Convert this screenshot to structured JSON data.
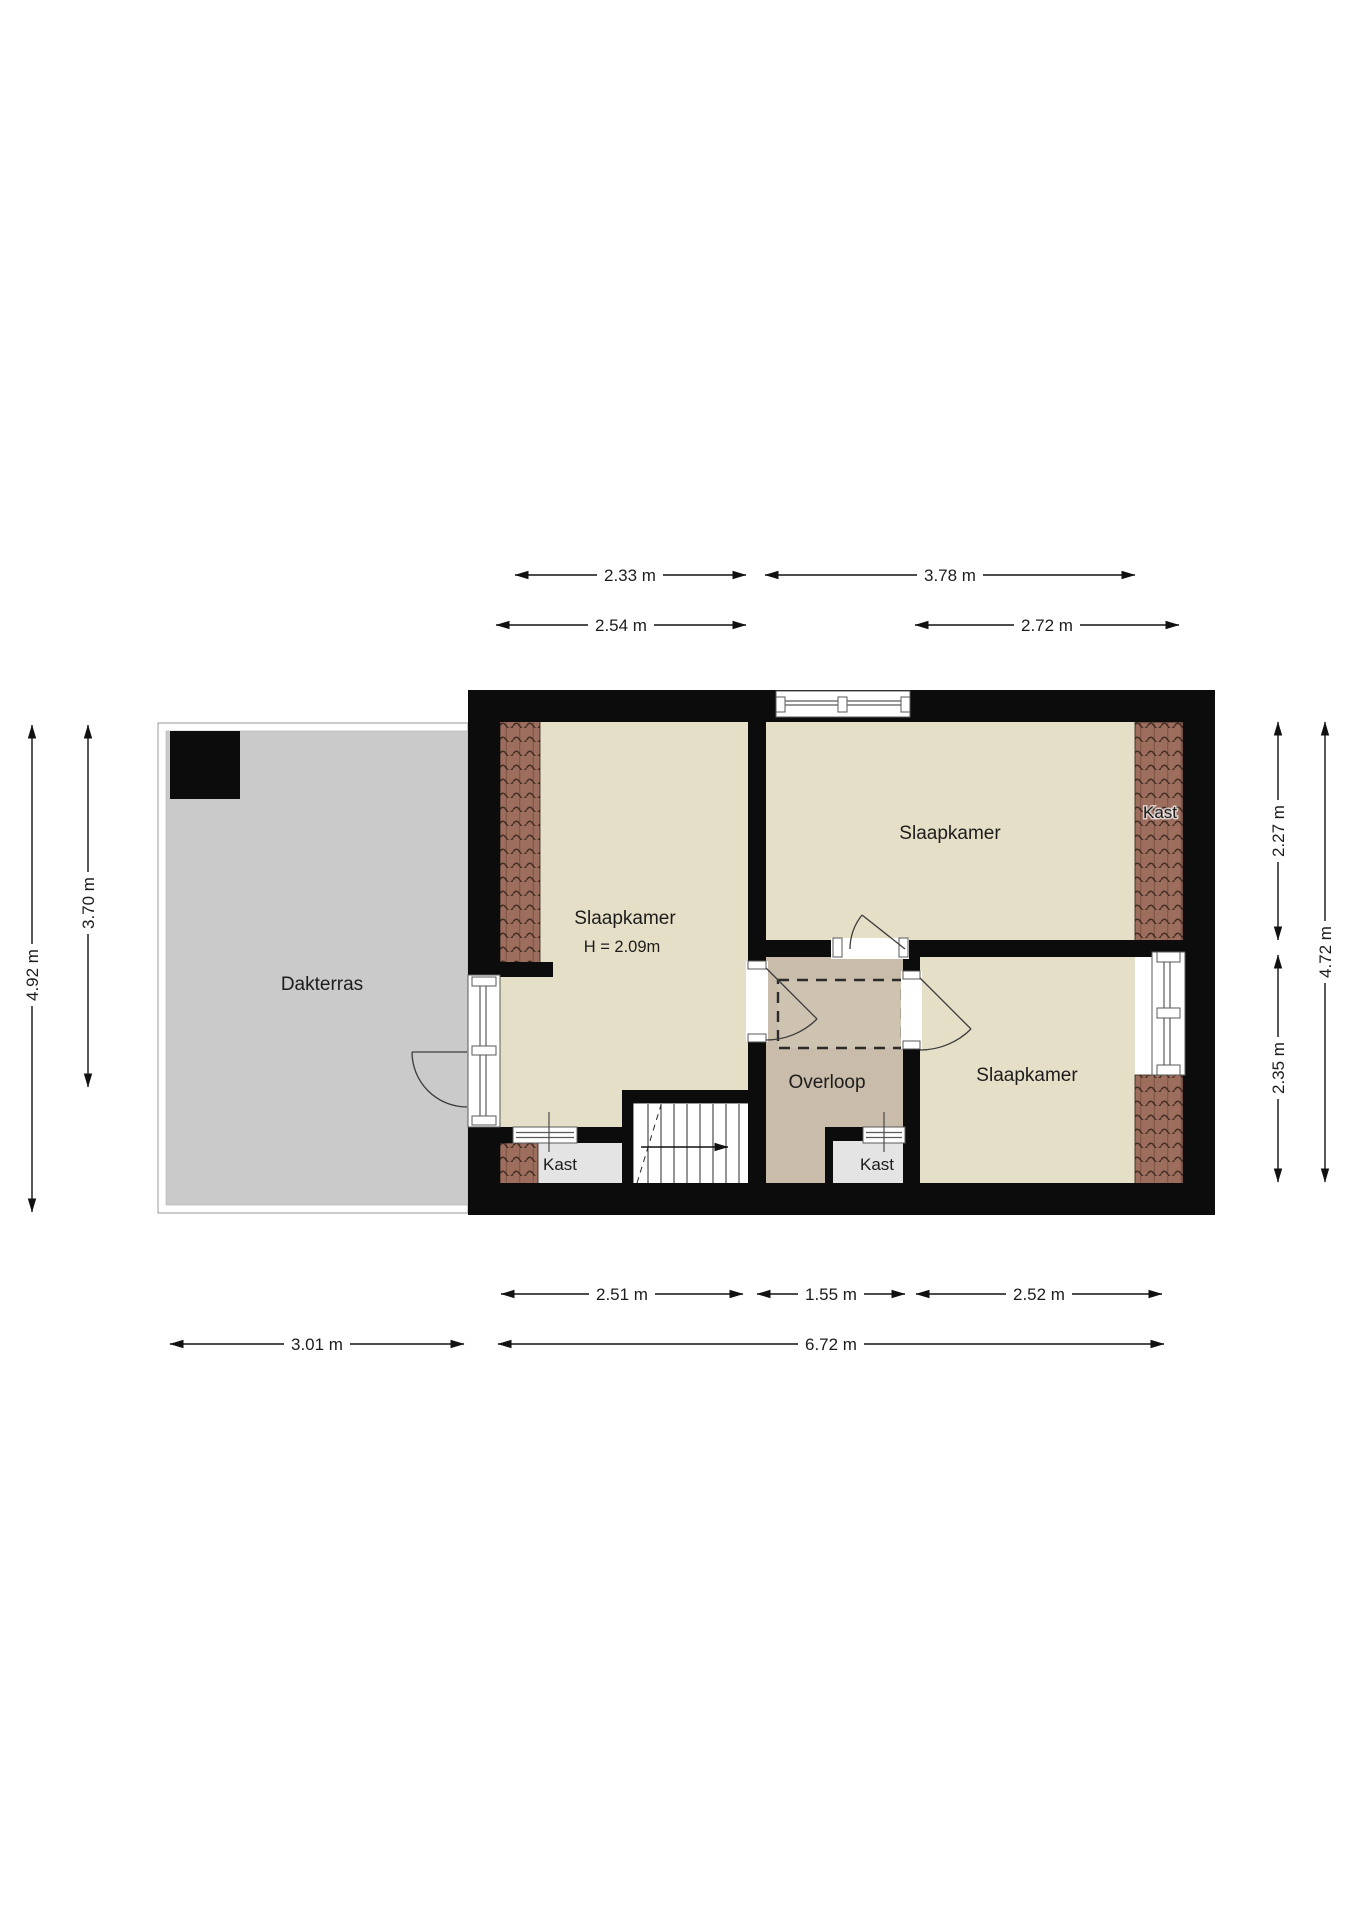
{
  "colors": {
    "wall": "#0c0c0c",
    "room_floor": "#e6dfc7",
    "overloop_floor": "#c9bcaa",
    "attic_hatch_fill": "#cec2b0",
    "kast_floor": "#e4e4e4",
    "terrace_floor": "#cacaca",
    "terrace_railing": "#ffffff",
    "roof_tiles": "#9d6e5e",
    "dimension_lines": "#111111"
  },
  "rooms": {
    "dakterras": "Dakterras",
    "slaapkamer_left": "Slaapkamer",
    "slaapkamer_left_height": "H = 2.09m",
    "slaapkamer_top_right": "Slaapkamer",
    "slaapkamer_bottom_right": "Slaapkamer",
    "overloop": "Overloop",
    "kast_top_right": "Kast",
    "kast_bottom_left": "Kast",
    "kast_bottom_middle": "Kast"
  },
  "dimensions": {
    "top": {
      "row1_left": "2.33 m",
      "row1_right": "3.78 m",
      "row2_left": "2.54 m",
      "row2_right": "2.72 m"
    },
    "bottom": {
      "row1_left": "2.51 m",
      "row1_middle": "1.55 m",
      "row1_right": "2.52 m",
      "row2_left": "3.01 m",
      "row2_right": "6.72 m"
    },
    "left": {
      "outer": "4.92 m",
      "inner": "3.70 m"
    },
    "right": {
      "inner_top": "2.27 m",
      "inner_bottom": "2.35 m",
      "outer": "4.72 m"
    }
  }
}
